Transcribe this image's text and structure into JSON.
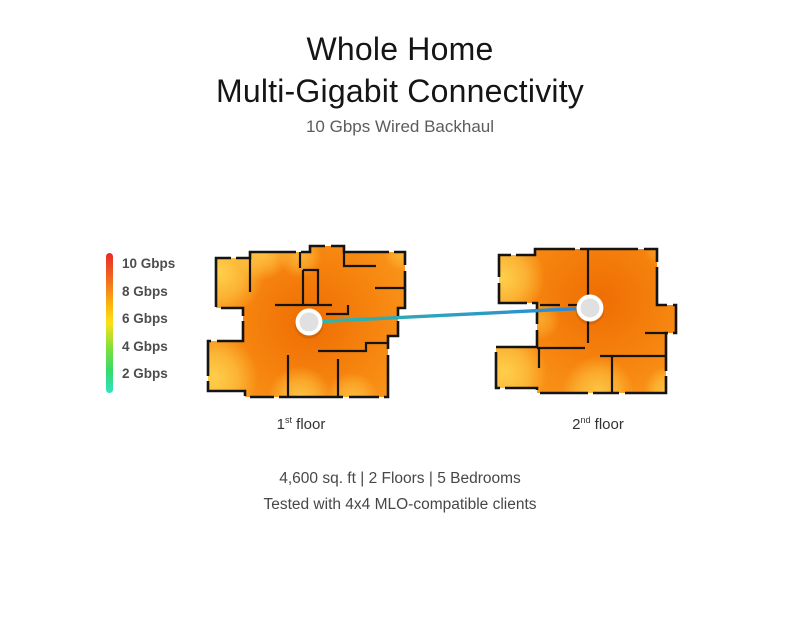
{
  "header": {
    "title_line1": "Whole Home",
    "title_line2": "Multi-Gigabit Connectivity",
    "subtitle": "10 Gbps Wired Backhaul"
  },
  "legend": {
    "items": [
      "10 Gbps",
      "8 Gbps",
      "6 Gbps",
      "4 Gbps",
      "2 Gbps"
    ],
    "gradient": [
      "#E8292A",
      "#F1701E",
      "#FBB90F",
      "#FFE014",
      "#7FE03C",
      "#35DB6A",
      "#30E2C3"
    ]
  },
  "floors": {
    "first": {
      "number": "1",
      "ordinal": "st",
      "word": " floor"
    },
    "second": {
      "number": "2",
      "ordinal": "nd",
      "word": " floor"
    }
  },
  "footer": {
    "line1": "4,600 sq. ft | 2 Floors | 5 Bedrooms",
    "line2": "Tested with 4x4 MLO-compatible clients"
  },
  "colors": {
    "heat_core": "#EE6D03",
    "heat_base": "#F6830E",
    "heat_soft": "#FA9A1C",
    "heat_edge": "#FFD24E",
    "link_start": "#2FB9A7",
    "link_end": "#2B87D8",
    "wall": "#141414",
    "node_fill": "#E0E0E0",
    "node_ring": "#FFFFFF"
  }
}
